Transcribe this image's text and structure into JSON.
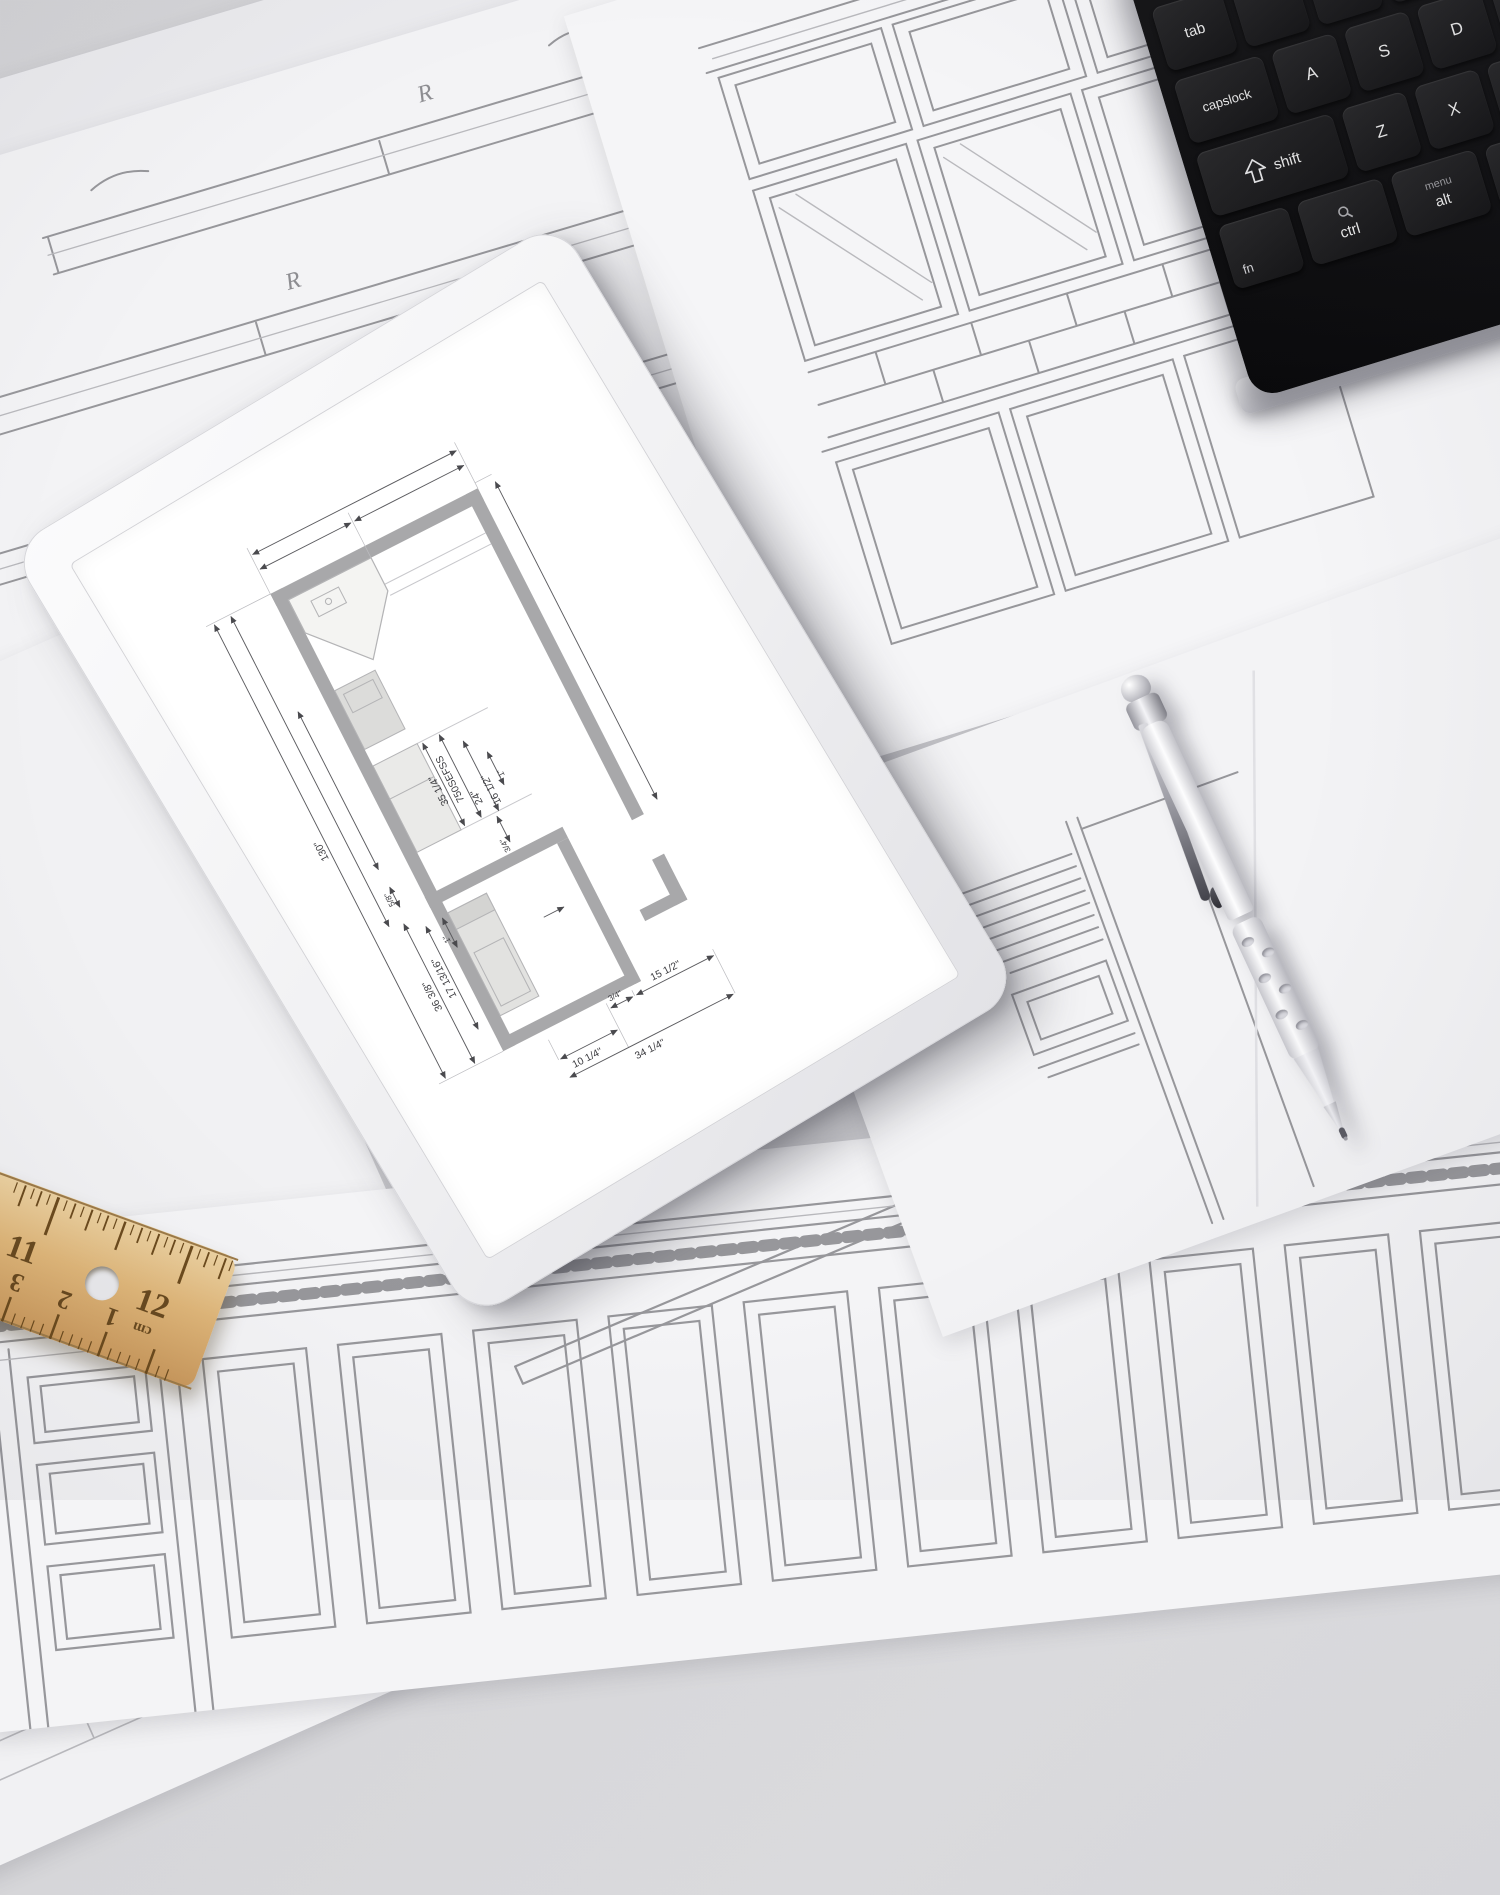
{
  "keyboard": {
    "keys": {
      "tab": "tab",
      "capslock": "capslock",
      "shift": "shift",
      "a": "A",
      "s": "S",
      "d": "D",
      "z": "Z",
      "x": "X",
      "c": "C",
      "fn": "fn",
      "ctrl": "ctrl",
      "alt": "alt",
      "menu": "menu"
    }
  },
  "tablet": {
    "floorplan": {
      "dims": {
        "overall": "130\"",
        "oven_w": "35 1/4\"",
        "model": "750SEFSS",
        "w24": "24\"",
        "w16": "16 1/2\"",
        "one_a": "1\"",
        "one_b": "1\"",
        "q34_a": "3/4\"",
        "q34_b": "3/4\"",
        "f58": "5/8\"",
        "h17": "17 13/16\"",
        "h36": "36 3/8\"",
        "w15": "15 1/2\"",
        "w10": "10 1/4\"",
        "w34": "34 1/4\""
      }
    }
  },
  "ruler": {
    "inch": {
      "eleven": "11",
      "twelve": "12"
    },
    "cm": {
      "three": "3",
      "two": "2",
      "one": "1"
    },
    "unit": "cm"
  },
  "sketch": {
    "r_mark": "R"
  },
  "colors": {
    "desk": "#d6d6d9",
    "paper": "#f3f3f5",
    "pencil_stroke": "#97979b",
    "keyboard_base": "#121214",
    "key_face": "#202022",
    "key_legend": "#e8e8e8",
    "tablet_body": "#f2f2f4",
    "screen": "#ffffff",
    "plan_wall": "#a8a8aa",
    "ruler_wood": "#dfb679",
    "ruler_marking": "#5e4018",
    "pen_body": "#f1f1f3"
  }
}
